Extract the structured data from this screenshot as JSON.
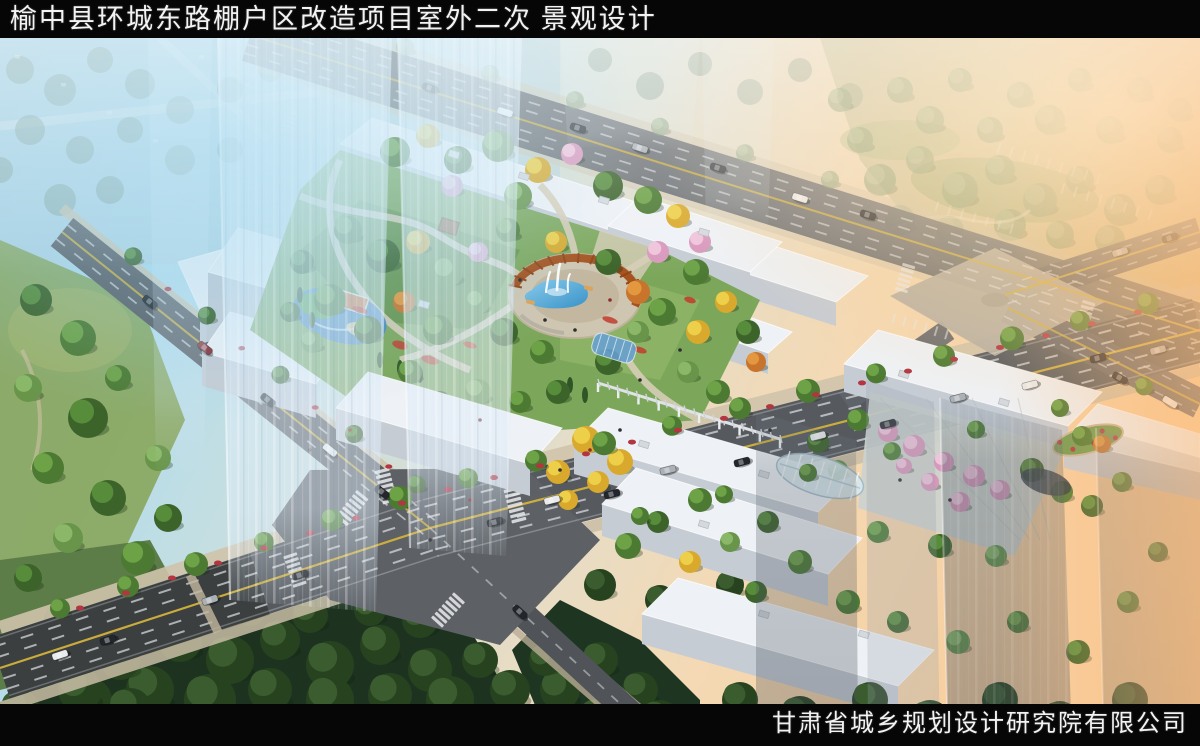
{
  "title_bar": {
    "text": "榆中县环城东路棚户区改造项目室外二次 景观设计"
  },
  "footer_bar": {
    "company_name": "甘肃省城乡规划设计研究院有限公司"
  },
  "scene": {
    "palette": {
      "sky_haze_blue": "#a9d6ea",
      "sunset_glow": "#ffd9a6",
      "asphalt": "#565a5f",
      "lane_yellow": "#d2b23c",
      "building_white": "#eef1f5",
      "building_facade": "#c6ccd4",
      "tree_green": "#5d8f3c",
      "tree_autumn_yellow": "#e0b531",
      "tree_orange": "#cf7c2e",
      "tree_blossom_pink": "#e2a6c6",
      "pergola_rust": "#a5521e",
      "fountain_blue": "#49a2d5",
      "playground_blue": "#4a86c2",
      "forest_dark": "#1d3320",
      "lawn_green": "#8aa862"
    },
    "landmarks": [
      "ghost-highrise-towers",
      "central-fountain-plaza",
      "pergola-ring",
      "children-playground",
      "glass-greenhouse",
      "street-intersection",
      "perimeter-retail-blocks",
      "city-park"
    ]
  }
}
